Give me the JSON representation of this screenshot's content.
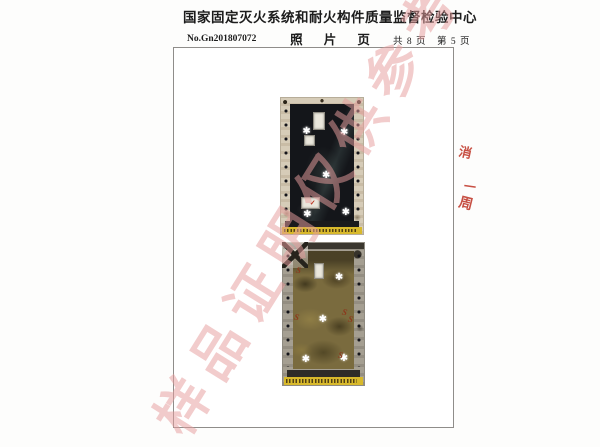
{
  "header": {
    "title": "国家固定灭火系统和耐火构件质量监督检验中心",
    "subtitle": "照 片 页",
    "report_no": "No.Gn201807072",
    "page_info": "共 8 页　第 5 页",
    "pages_total": 8,
    "page_current": 5
  },
  "watermark": {
    "text": "样品证明仅供参考",
    "color": "#e79e9e"
  },
  "annotations": {
    "marks": [
      "消",
      "一",
      "周"
    ],
    "color": "#c0392b"
  },
  "colors": {
    "caption_strip": "#d8b92b",
    "door_before": "#14161a",
    "door_after": "#7a6b3e",
    "frame_border": "#8f8d8a"
  },
  "marker_glyphs": {
    "star": "✱",
    "squiggle": "S",
    "tick": "✓"
  },
  "photos": [
    {
      "id": "door-before-test",
      "caption_strip": true,
      "stars": [
        {
          "x": 26,
          "y": 21
        },
        {
          "x": 72,
          "y": 22
        },
        {
          "x": 50,
          "y": 54
        },
        {
          "x": 27,
          "y": 82
        },
        {
          "x": 74,
          "y": 81
        }
      ],
      "labels": [
        {
          "x": 39,
          "y": 10,
          "w": 12,
          "h": 12
        },
        {
          "x": 28,
          "y": 27,
          "w": 11,
          "h": 7
        },
        {
          "x": 24,
          "y": 73,
          "w": 21,
          "h": 7
        }
      ],
      "ticks": [
        {
          "x": 35,
          "y": 75
        }
      ]
    },
    {
      "id": "door-after-test",
      "caption_strip": true,
      "stars": [
        {
          "x": 64,
          "y": 21
        },
        {
          "x": 44,
          "y": 51
        },
        {
          "x": 23,
          "y": 79
        },
        {
          "x": 70,
          "y": 78
        }
      ],
      "labels": [
        {
          "x": 38,
          "y": 14,
          "w": 10,
          "h": 10
        }
      ],
      "squiggles": [
        {
          "x": 13,
          "y": 49
        },
        {
          "x": 73,
          "y": 46
        },
        {
          "x": 68,
          "y": 76
        },
        {
          "x": 80,
          "y": 51
        },
        {
          "x": 16,
          "y": 16
        }
      ]
    }
  ]
}
